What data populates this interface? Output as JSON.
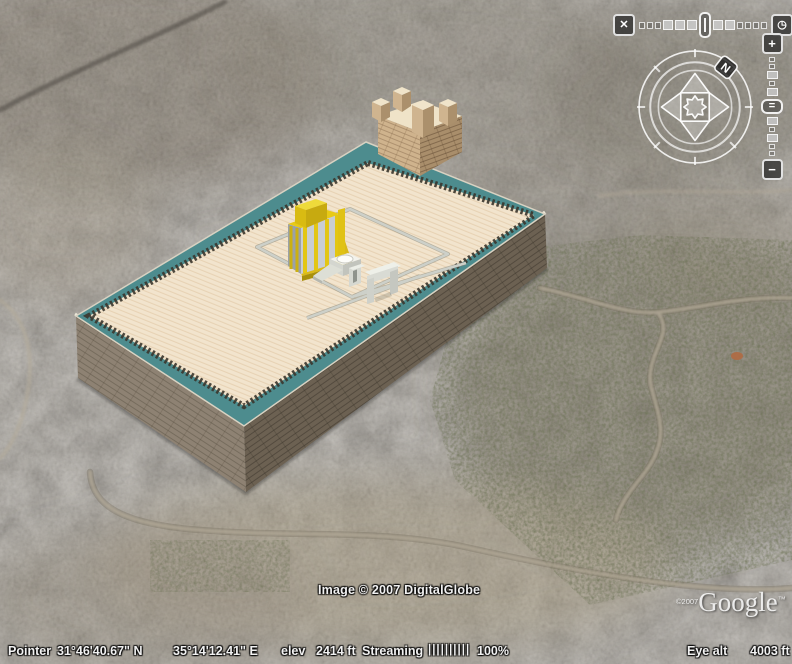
{
  "app": {
    "name": "Google Earth 3D viewer"
  },
  "icons": {
    "time_range_icon": "✕",
    "time_clock_icon": "◷",
    "north": "N",
    "zoom_in": "+",
    "zoom_out": "−",
    "slider_handle": "="
  },
  "watermarks": {
    "imagery_credit": "Image © 2007 DigitalGlobe",
    "logo_copyright": "©2007",
    "logo_text": "Google",
    "logo_tm": "™"
  },
  "status_bar": {
    "pointer_label": "Pointer",
    "latitude": "31°46'40.67\" N",
    "longitude": "35°14'12.41\" E",
    "elevation_label": "elev",
    "elevation_value": "2414 ft",
    "streaming_label": "Streaming",
    "streaming_bars": "||||||||||",
    "streaming_percent": "100%",
    "eye_alt_label": "Eye alt",
    "eye_alt_value": "4003 ft"
  },
  "model": {
    "description_names": [
      "temple-mount-platform",
      "temple-building",
      "altar",
      "arch-structure",
      "antonia-fortress"
    ],
    "colors": {
      "rim_teal": "#4d8c8e",
      "platform_cream": "#f2e4cd",
      "wall_stone_light": "#8e8273",
      "wall_stone_dark": "#6c6152",
      "temple_gold": "#e8ca16",
      "fortress_tan": "#cfb38d",
      "altar_white": "#f2f2ec"
    }
  }
}
